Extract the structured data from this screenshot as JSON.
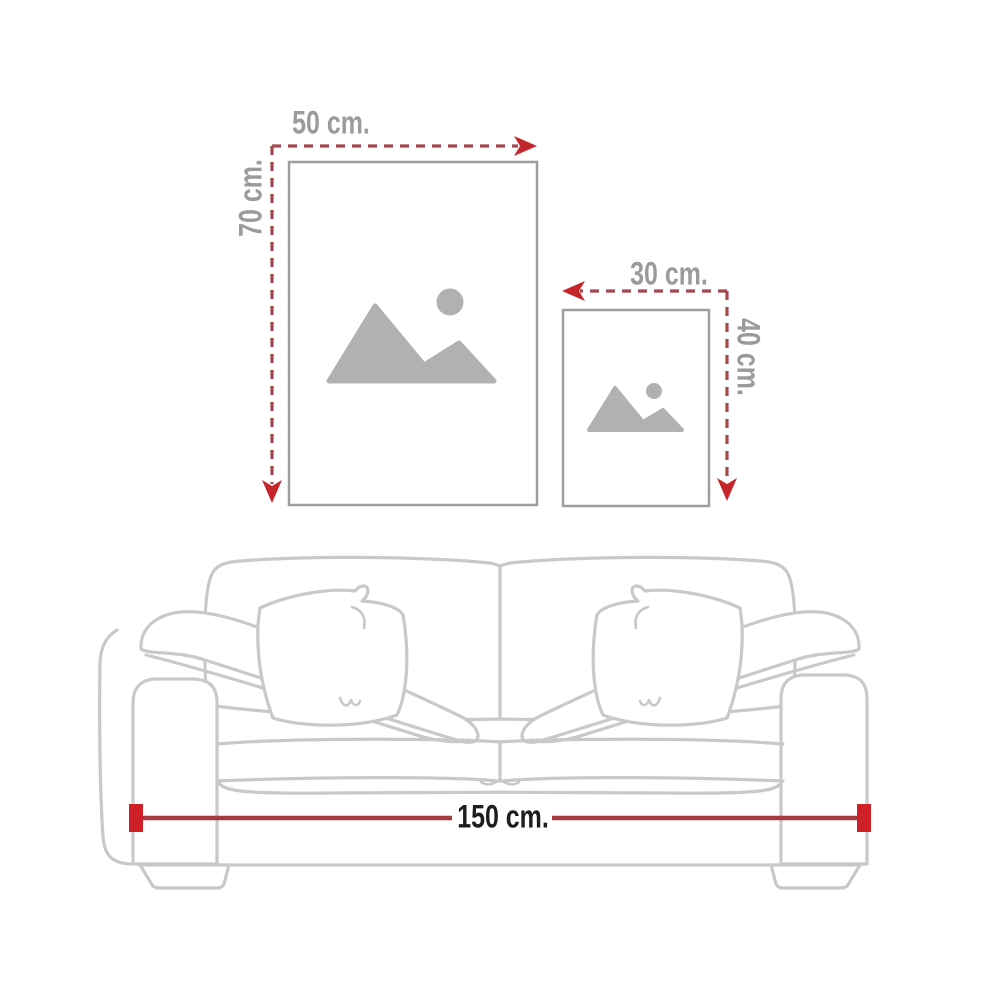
{
  "page": {
    "background": "#ffffff",
    "description_labels_visible": [
      "50 cm.",
      "70 cm.",
      "30 cm.",
      "40 cm.",
      "150 cm."
    ]
  },
  "size_guide": {
    "large_frame": {
      "width_label": "50 cm.",
      "height_label": "70 cm.",
      "placeholder_icon": "image-placeholder-icon"
    },
    "small_frame": {
      "width_label": "30 cm.",
      "height_label": "40 cm.",
      "placeholder_icon": "image-placeholder-icon"
    },
    "sofa": {
      "width_label": "150 cm."
    }
  },
  "colors": {
    "arrow_red": "#c5262c",
    "dash_red": "#a3484c",
    "dimension_line_red": "#a63b3e",
    "dimension_cap_red": "#ce2127",
    "label_gray": "#9b9b9b",
    "sofa_line_gray": "#c9c9c9",
    "frame_border_gray": "#9d9d9d",
    "placeholder_icon_gray": "#b1b1b1",
    "sofa_label_dark": "#1d1d1d"
  }
}
